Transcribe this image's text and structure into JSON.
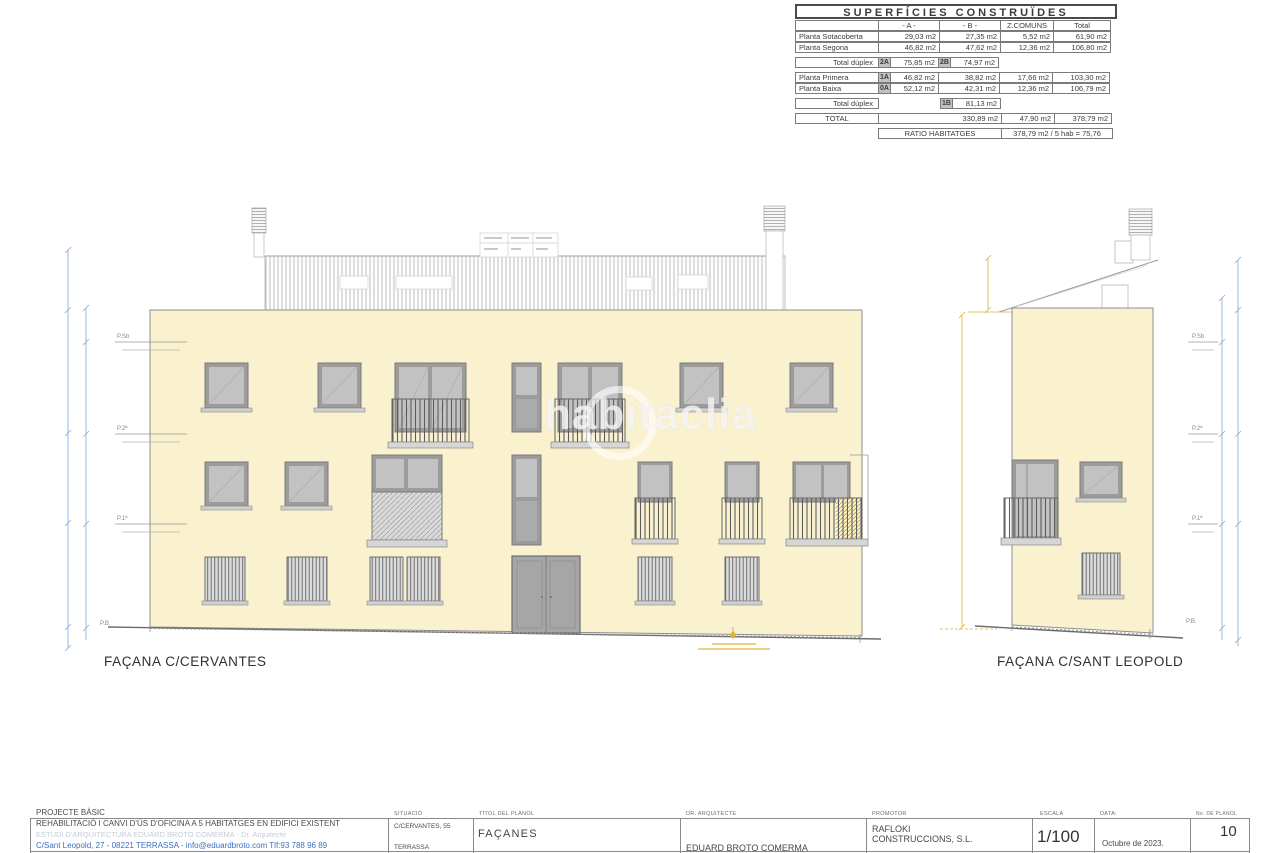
{
  "watermark": "habitaclia",
  "surface_table": {
    "title": "SUPERFÍCIES CONSTRUÏDES",
    "headers": {
      "a": "- A -",
      "b": "- B -",
      "comuns": "Z.COMUNS",
      "total": "Total"
    },
    "sotacoberta": {
      "label": "Planta Sotacoberta",
      "a": "29,03 m2",
      "b": "27,35 m2",
      "comuns": "5,52 m2",
      "total": "61,90 m2"
    },
    "segona": {
      "label": "Planta Segona",
      "a": "46,82 m2",
      "b": "47,62 m2",
      "comuns": "12,36 m2",
      "total": "106,80 m2"
    },
    "duplex_top": {
      "label": "Total dúplex",
      "badge_a": "2A",
      "a": "75,85 m2",
      "badge_b": "2B",
      "b": "74,97 m2"
    },
    "primera": {
      "label": "Planta Primera",
      "badge": "1A",
      "a": "46,82 m2",
      "b": "38,82 m2",
      "comuns": "17,66 m2",
      "total": "103,30 m2"
    },
    "baixa": {
      "label": "Planta Baixa",
      "badge": "0A",
      "a": "52,12 m2",
      "b": "42,31 m2",
      "comuns": "12,36 m2",
      "total": "106,79 m2"
    },
    "duplex_bottom": {
      "label": "Total dúplex",
      "badge": "1B",
      "value": "81,13 m2"
    },
    "total_row": {
      "label": "TOTAL",
      "ab": "330,89 m2",
      "comuns": "47,90 m2",
      "total": "378,79 m2"
    },
    "ratio_row": {
      "label": "RATIO HABITATGES",
      "value": "378,79 m2 / 5 hab = 75,76"
    }
  },
  "facades": {
    "cervantes_caption": "FAÇANA C/CERVANTES",
    "sant_leopold_caption": "FAÇANA C/SANT LEOPOLD",
    "level_sb": "P.Sb",
    "level_p2": "P.2ª",
    "level_p1": "P.1ª",
    "level_pb": "P.B."
  },
  "title_block": {
    "project_type": "PROJECTE BÀSIC",
    "project_title": "REHABILITACIÓ I CANVI D'ÚS D'OFICINA A 5 HABITATGES EN EDIFICI EXISTENT",
    "studio_line": "ESTUDI D'ARQUITECTURA EDUARD BROTO COMERMA - Dr. Arquitecte",
    "contact_line": "C/Sant Leopold, 27 - 08221 TERRASSA - info@eduardbroto.com  Tlf:93 788 96 89",
    "situacio_label": "SITUACIÓ",
    "situacio_value": "C/CERVANTES, 55",
    "situacio_city": "TERRASSA",
    "titol_label": "TÍTOL DEL PLÀNOL",
    "titol_value": "FAÇANES",
    "arquitecte_label": "DR. ARQUITECTE",
    "arquitecte_value": "EDUARD BROTO COMERMA",
    "promotor_label": "PROMOTOR",
    "promotor_value": "RAFLOKI CONSTRUCCIONS, S.L.",
    "escala_label": "ESCALA",
    "escala_value": "1/100",
    "data_label": "DATA:",
    "data_value": "Octubre de 2023.",
    "planol_label": "No. DE PLÀNOL",
    "planol_value": "10"
  },
  "colors": {
    "wall_fill": "#faf1cf",
    "dimension_blue": "#7fa9da",
    "annotation_yellow": "#dcb33c",
    "contact_blue": "#3a6fc4"
  }
}
